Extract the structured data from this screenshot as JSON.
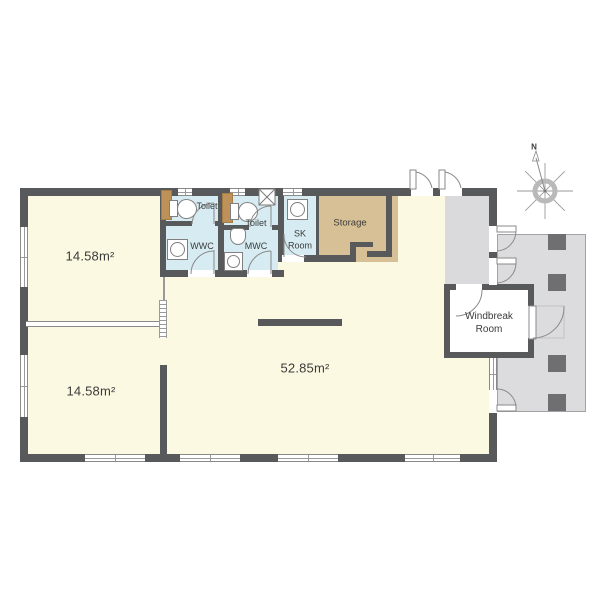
{
  "rooms": {
    "room_top_left": {
      "area": "14.58m²"
    },
    "room_bottom_left": {
      "area": "14.58m²"
    },
    "main_room": {
      "area": "52.85m²"
    },
    "toilet_1": {
      "label": "Toilet"
    },
    "toilet_2": {
      "label": "Toilet"
    },
    "wwc": {
      "label": "WWC"
    },
    "mwc": {
      "label": "MWC"
    },
    "sk_room": {
      "label": "SK Room"
    },
    "storage": {
      "label": "Storage"
    },
    "windbreak_room": {
      "label": "Windbreak Room"
    }
  },
  "compass": {
    "north_label": "N"
  },
  "colors": {
    "floor_yellow": "#fcf9e2",
    "floor_blue": "#d6ecf2",
    "floor_tan": "#d7c096",
    "terrace_gray": "#dcdcde",
    "wall_gray": "#58595b",
    "pillar_gray": "#6f6f71",
    "wood_brown": "#bd9157"
  }
}
